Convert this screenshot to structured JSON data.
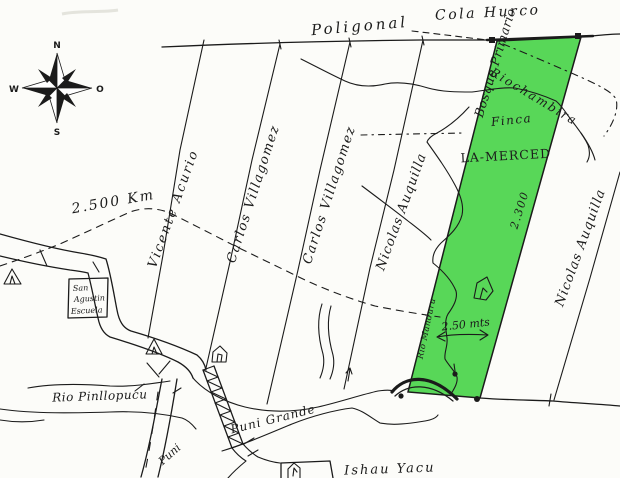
{
  "compass": {
    "north": "N",
    "south": "S",
    "west": "W",
    "east": "O"
  },
  "map_labels": {
    "cola_hurco": "Cola Hurco",
    "poligonal": "Poligonal",
    "bosque_primario": "Bosque Primario",
    "riochambira": "Riochambira",
    "finca": "Finca",
    "parcel_name": "LA-MERCED",
    "parcel_length": "2.300",
    "parcel_width": "2.50 mts",
    "rio_manduru": "Rio Manduru",
    "distance_km": "2.500 Km",
    "rio_pinllopucu": "Rio Pinllopucu",
    "puni_grande": "Puni Grande",
    "puni": "Puni",
    "ishau_yacu": "Ishau Yacu"
  },
  "school": {
    "line1": "San",
    "line2": "Agustin",
    "line3": "Escuela"
  },
  "strips": [
    {
      "owner": "Vicente Acurio"
    },
    {
      "owner": "Carlos Villagomez"
    },
    {
      "owner": "Carlos Villagomez"
    },
    {
      "owner": "Nicolas Auquilla"
    },
    {
      "owner": "Nicolas Auquilla"
    }
  ],
  "colors": {
    "parcel_fill": "#58d758",
    "ink": "#1b1b1b",
    "paper": "#fcfcf9"
  }
}
